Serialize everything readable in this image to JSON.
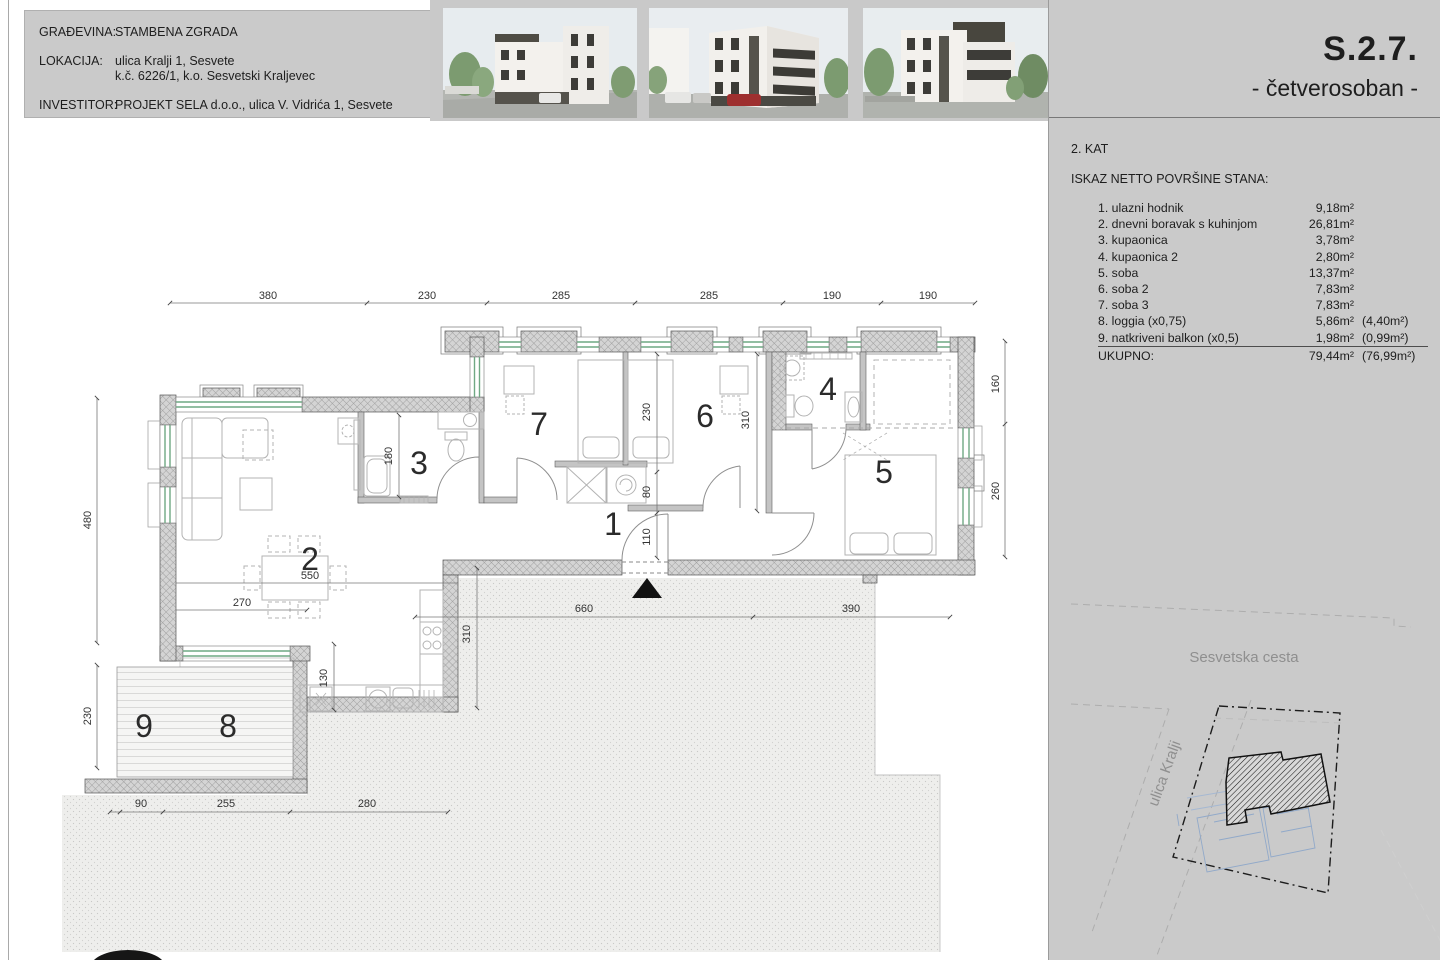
{
  "header": {
    "rows": [
      {
        "label": "GRAĐEVINA:",
        "value": "STAMBENA ZGRADA"
      },
      {
        "label": "LOKACIJA:",
        "value": "ulica Kralji 1, Sesvete",
        "value2": "k.č. 6226/1, k.o. Sesvetski Kraljevec"
      },
      {
        "label": "INVESTITOR:",
        "value": "PROJEKT SELA d.o.o., ulica V. Vidrića 1, Sesvete"
      }
    ]
  },
  "title": {
    "code": "S.2.7.",
    "subtitle": "- četverosoban -"
  },
  "panel": {
    "floor": "2. KAT",
    "list_title": "ISKAZ NETTO POVRŠINE STANA:",
    "rows": [
      {
        "name": "1. ulazni hodnik",
        "area": "9,18m²",
        "reduced": ""
      },
      {
        "name": "2. dnevni boravak s kuhinjom",
        "area": "26,81m²",
        "reduced": ""
      },
      {
        "name": "3. kupaonica",
        "area": "3,78m²",
        "reduced": ""
      },
      {
        "name": "4. kupaonica 2",
        "area": "2,80m²",
        "reduced": ""
      },
      {
        "name": "5. soba",
        "area": "13,37m²",
        "reduced": ""
      },
      {
        "name": "6. soba 2",
        "area": "7,83m²",
        "reduced": ""
      },
      {
        "name": "7. soba 3",
        "area": "7,83m²",
        "reduced": ""
      },
      {
        "name": "8. loggia (x0,75)",
        "area": "5,86m²",
        "reduced": "(4,40m²)"
      },
      {
        "name": "9. natkriveni balkon (x0,5)",
        "area": "1,98m²",
        "reduced": "(0,99m²)"
      }
    ],
    "total": {
      "name": "UKUPNO:",
      "area": "79,44m²",
      "reduced": "(76,99m²)"
    }
  },
  "site": {
    "street_top": "Sesvetska cesta",
    "street_left": "ulica Kralji"
  },
  "plan": {
    "rooms": [
      "1",
      "2",
      "3",
      "4",
      "5",
      "6",
      "7",
      "8",
      "9"
    ],
    "dims_top": [
      "380",
      "230",
      "285",
      "285",
      "190",
      "190"
    ],
    "dims_left": [
      "480",
      "230"
    ],
    "dims_right": [
      "160",
      "260"
    ],
    "dims_bottom": [
      "660",
      "390"
    ],
    "dims_bottom_left": [
      "90",
      "255",
      "280"
    ],
    "dim_bath3": "180",
    "dim_room7_depth": "230",
    "dim_niche": "80",
    "dim_entry": "110",
    "dim_room6": "310",
    "dim_kitchen_depth": "310",
    "dim_kitchen_width": "130",
    "dim_table": "550",
    "dim_living": "270"
  },
  "colors": {
    "panel_gray": "#cacaca",
    "window_green": "#6fa883",
    "wall_hatch_bg": "#d4d4d4",
    "entry_arrow": "#111111"
  }
}
